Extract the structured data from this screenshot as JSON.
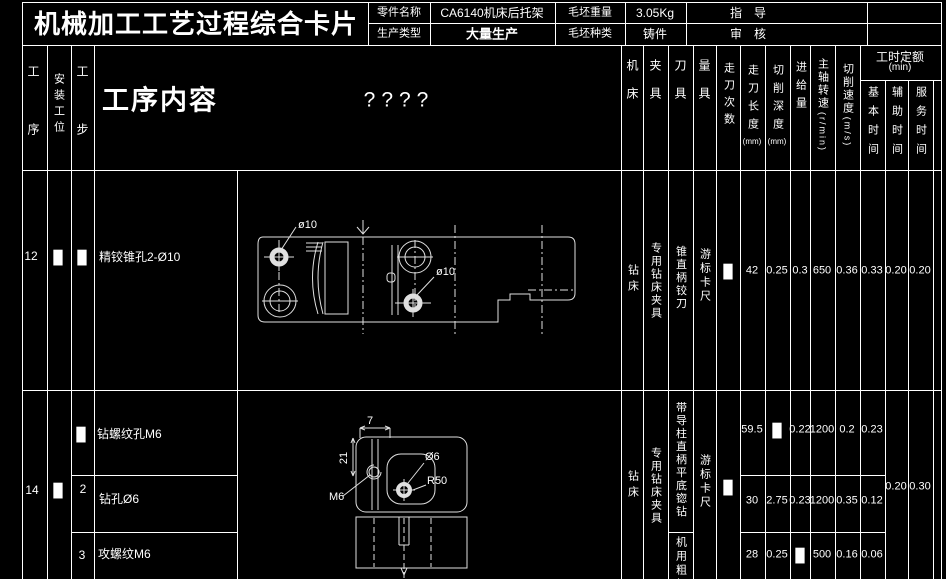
{
  "title_block": {
    "card_title": "机械加工工艺过程综合卡片",
    "part_name_label": "零件名称",
    "part_name_value": "CA6140机床后托架",
    "blank_weight_label": "毛坯重量",
    "blank_weight_value": "3.05Kg",
    "guide_label": "指　导",
    "production_type_label": "生产类型",
    "production_type_value": "大量生产",
    "blank_type_label": "毛坯种类",
    "blank_type_value": "铸件",
    "audit_label": "审　核"
  },
  "header": {
    "col_process": "工序",
    "col_setup": "安装工位",
    "col_step": "工步",
    "col_content": "工序内容",
    "col_unknown": "????",
    "col_machine": "机床",
    "col_fixture": "夹具",
    "col_tool": "刀具",
    "col_gauge": "量具",
    "col_passes": "走刀次数",
    "col_pass_length": "走刀长度",
    "col_pass_length_unit": "(mm)",
    "col_cut_depth": "切削深度",
    "col_cut_depth_unit": "(mm)",
    "col_feed": "进给量",
    "col_spindle": "主轴转速",
    "col_spindle_unit": "(r/min)",
    "col_cut_speed": "切削速度",
    "col_cut_speed_unit": "(m/s)",
    "col_time_group": "工时定额",
    "col_time_group_unit": "(min)",
    "col_time_basic": "基本时间",
    "col_time_aux": "辅助时间",
    "col_time_service": "服务时间"
  },
  "rows": {
    "r12": {
      "process_no": "12",
      "setup": "█",
      "step": "█",
      "content": "精铰锥孔2-Ø10",
      "machine": "钻床",
      "fixture": "专用钻床夹具",
      "tool": "锥直柄铰刀",
      "gauge": "游标卡尺",
      "passes": "█",
      "pass_length": "42",
      "cut_depth": "0.25",
      "feed": "0.3",
      "spindle": "650",
      "cut_speed": "0.36",
      "time_basic": "0.33",
      "time_aux": "0.20",
      "time_service": "0.20"
    },
    "r14": {
      "process_no": "14",
      "setup": "█",
      "machine": "钻床",
      "fixture": "专用钻床夹具",
      "tool_steps12": "带导柱直柄平底锪钻",
      "tool_step3": "机用粗柄",
      "gauge": "游标卡尺",
      "passes": "█",
      "time_aux": "0.20",
      "time_service": "0.30",
      "steps": [
        {
          "step": "█",
          "content": "钻螺纹孔M6",
          "pass_length": "59.5",
          "cut_depth": "█",
          "feed": "0.22",
          "spindle": "1200",
          "cut_speed": "0.2",
          "time_basic": "0.23"
        },
        {
          "step": "2",
          "content": "钻孔Ø6",
          "pass_length": "30",
          "cut_depth": "2.75",
          "feed": "0.23",
          "spindle": "1200",
          "cut_speed": "0.35",
          "time_basic": "0.12"
        },
        {
          "step": "3",
          "content": "攻螺纹M6",
          "pass_length": "28",
          "cut_depth": "0.25",
          "feed": "█",
          "spindle": "500",
          "cut_speed": "0.16",
          "time_basic": "0.06"
        }
      ]
    }
  },
  "drawings": {
    "d12": {
      "hole_label_1": "ø10",
      "hole_label_2": "ø10"
    },
    "d14": {
      "dim_width": "7",
      "dim_height": "21",
      "thread_label": "M6",
      "dia_label": "Ø6",
      "radius_label": "R50"
    }
  },
  "colors": {
    "background": "#000000",
    "line": "#ffffff",
    "text": "#ffffff"
  }
}
